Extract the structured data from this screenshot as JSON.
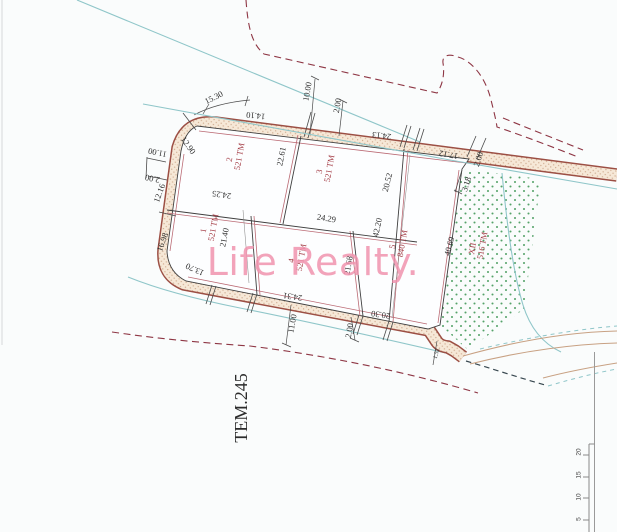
{
  "watermark": {
    "text": "Life Realty."
  },
  "parcel_ref": {
    "text": "ΤΕΜ.245"
  },
  "plots": [
    {
      "id": "1",
      "area": "521 ΤΜ",
      "x": 206,
      "y": 231,
      "r": -80
    },
    {
      "id": "2",
      "area": "521 ΤΜ",
      "x": 232,
      "y": 160,
      "r": -80
    },
    {
      "id": "3",
      "area": "521 ΤΜ",
      "x": 322,
      "y": 172,
      "r": -80
    },
    {
      "id": "4",
      "area": "521 ΤΜ",
      "x": 294,
      "y": 261,
      "r": -80
    },
    {
      "id": "5",
      "area": "840 ΤΜ",
      "x": 395,
      "y": 247,
      "r": -80
    },
    {
      "id": "XII",
      "area": "516 ΤΜ",
      "x": 475,
      "y": 249,
      "r": -80
    }
  ],
  "dimensions": [
    {
      "t": "15.30",
      "x": 215,
      "y": 100,
      "r": -26
    },
    {
      "t": "14.10",
      "x": 256,
      "y": 113,
      "r": 186
    },
    {
      "t": "10.00",
      "x": 310,
      "y": 92,
      "r": -80
    },
    {
      "t": "2.00",
      "x": 340,
      "y": 106,
      "r": -80
    },
    {
      "t": "24.13",
      "x": 382,
      "y": 133,
      "r": 187
    },
    {
      "t": "17.12",
      "x": 449,
      "y": 152,
      "r": 190
    },
    {
      "t": "2.00",
      "x": 481,
      "y": 160,
      "r": -72
    },
    {
      "t": "3.18",
      "x": 469,
      "y": 185,
      "r": -72
    },
    {
      "t": "20.52",
      "x": 390,
      "y": 183,
      "r": -76
    },
    {
      "t": "42.20",
      "x": 380,
      "y": 228,
      "r": -78
    },
    {
      "t": "40.69",
      "x": 452,
      "y": 247,
      "r": -75
    },
    {
      "t": "12.90",
      "x": 186,
      "y": 147,
      "r": 55
    },
    {
      "t": "11.00",
      "x": 158,
      "y": 150,
      "r": 192
    },
    {
      "t": "2.00",
      "x": 153,
      "y": 176,
      "r": 192
    },
    {
      "t": "12.16",
      "x": 162,
      "y": 194,
      "r": -70
    },
    {
      "t": "16.98",
      "x": 165,
      "y": 243,
      "r": -70
    },
    {
      "t": "13.70",
      "x": 196,
      "y": 267,
      "r": 205
    },
    {
      "t": "24.25",
      "x": 222,
      "y": 192,
      "r": 188
    },
    {
      "t": "22.61",
      "x": 284,
      "y": 157,
      "r": -79
    },
    {
      "t": "24.29",
      "x": 326,
      "y": 221,
      "r": 9
    },
    {
      "t": "21.40",
      "x": 227,
      "y": 238,
      "r": -79
    },
    {
      "t": "21.68",
      "x": 351,
      "y": 266,
      "r": -80
    },
    {
      "t": "24.31",
      "x": 293,
      "y": 294,
      "r": 188
    },
    {
      "t": "20.30",
      "x": 381,
      "y": 312,
      "r": 188
    },
    {
      "t": "11.00",
      "x": 295,
      "y": 324,
      "r": -80
    },
    {
      "t": "2.00",
      "x": 352,
      "y": 331,
      "r": -80
    },
    {
      "t": "1.52",
      "x": 438,
      "y": 354,
      "r": -75,
      "s": 6
    }
  ],
  "scale_bar": {
    "labels": [
      {
        "t": "20",
        "y": 452
      },
      {
        "t": "15",
        "y": 475
      },
      {
        "t": "10",
        "y": 497
      },
      {
        "t": "5",
        "y": 519
      }
    ]
  },
  "colors": {
    "background": "#fafcfc",
    "road_fill": "#f6e8d7",
    "road_dot": "#c9a183",
    "road_edge": "#9c4f44",
    "lot_line": "#3f3f3f",
    "lot_line_companion": "#bb6a74",
    "boundary_dashed": "#8e3644",
    "cadastral_cyan": "#8fc6c9",
    "green_dot": "#55a269",
    "plot_label": "#a33b44",
    "dimension_text": "#2e2e2e",
    "watermark_pink": "#f194af"
  }
}
